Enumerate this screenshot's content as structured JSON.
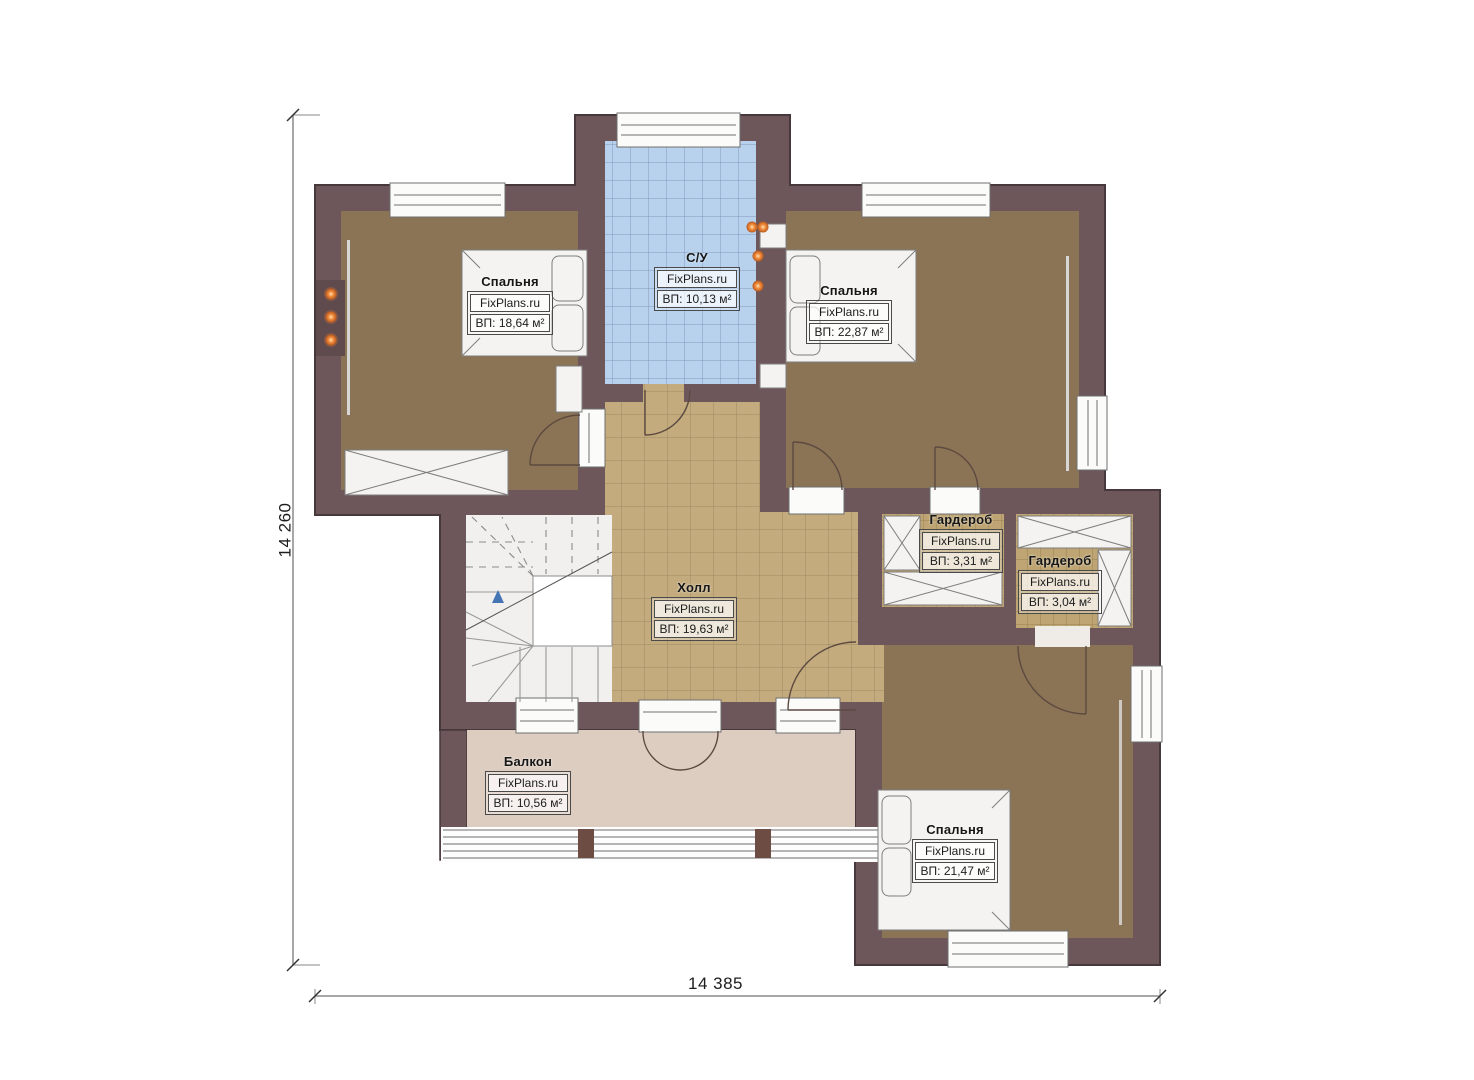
{
  "watermark": "FixPlans.ru",
  "dimensions": {
    "height_label": "14 260",
    "width_label": "14 385"
  },
  "rooms": [
    {
      "id": "bedroom-top-left",
      "name": "Спальня",
      "watermark": "FixPlans.ru",
      "area": "ВП: 18,64 м²"
    },
    {
      "id": "bathroom",
      "name": "С/У",
      "watermark": "FixPlans.ru",
      "area": "ВП: 10,13 м²"
    },
    {
      "id": "bedroom-top-right",
      "name": "Спальня",
      "watermark": "FixPlans.ru",
      "area": "ВП: 22,87 м²"
    },
    {
      "id": "wardrobe-1",
      "name": "Гардероб",
      "watermark": "FixPlans.ru",
      "area": "ВП: 3,31 м²"
    },
    {
      "id": "wardrobe-2",
      "name": "Гардероб",
      "watermark": "FixPlans.ru",
      "area": "ВП: 3,04 м²"
    },
    {
      "id": "hall",
      "name": "Холл",
      "watermark": "FixPlans.ru",
      "area": "ВП: 19,63 м²"
    },
    {
      "id": "balcony",
      "name": "Балкон",
      "watermark": "FixPlans.ru",
      "area": "ВП: 10,56 м²"
    },
    {
      "id": "bedroom-bottom",
      "name": "Спальня",
      "watermark": "FixPlans.ru",
      "area": "ВП: 21,47 м²"
    }
  ],
  "colors": {
    "wall": "#6e575a",
    "wall-dark": "#47383b",
    "floor-bedroom": "#8b7355",
    "hall-tile": "#c3ab7e",
    "bath-tile": "#b8d2ee",
    "ward-tile": "#bea573",
    "floor-balcony": "#ddccc0",
    "stairs-bg": "#f1f0ee",
    "accent-orange": "#e07b33",
    "dimension-line": "#8a8a8a"
  }
}
